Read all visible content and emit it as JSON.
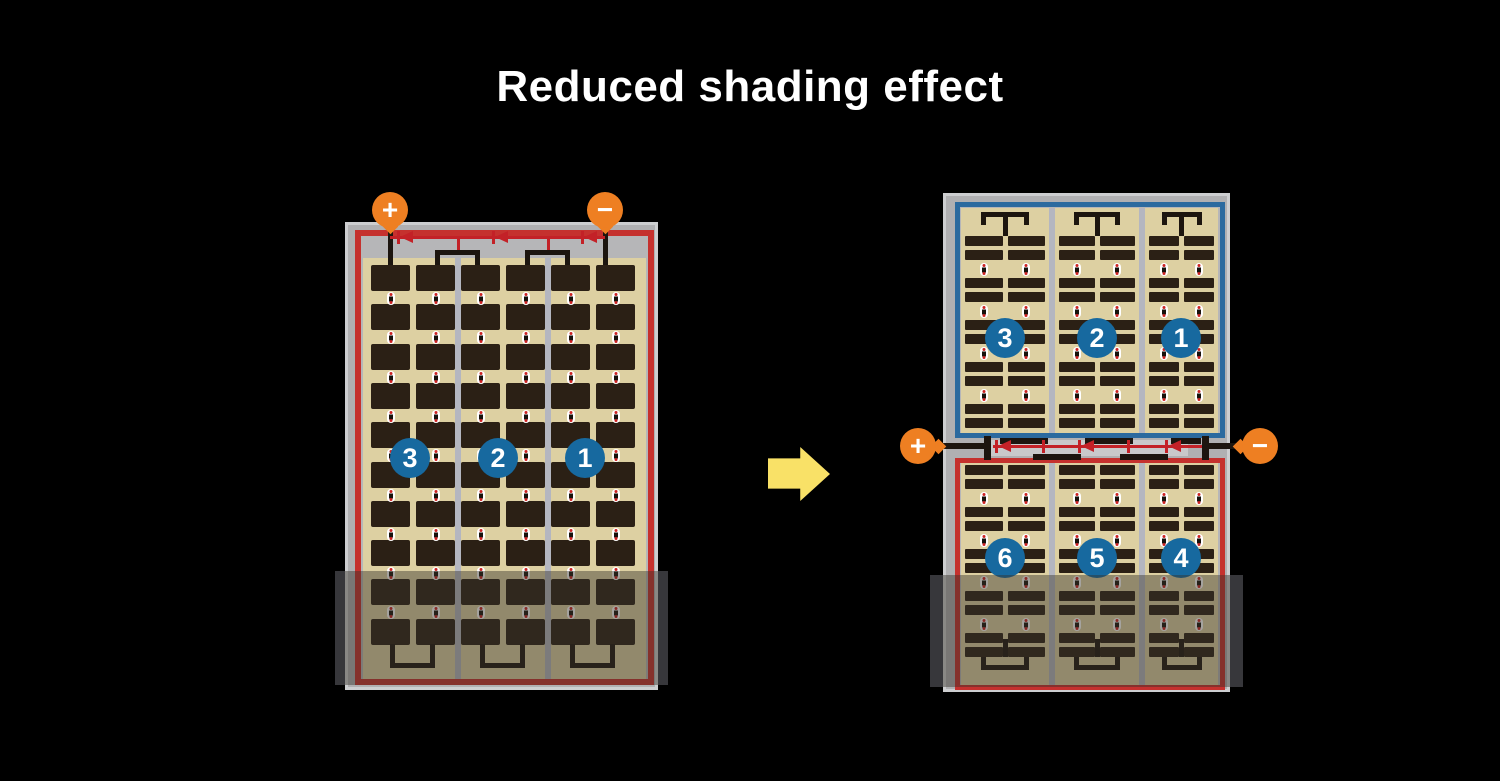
{
  "title": "Reduced shading effect",
  "colors": {
    "background": "#000000",
    "frame_gray": "#b0b0b2",
    "frame_edge": "#cdced0",
    "inner_gray": "#b6b6b8",
    "border_red": "#c5312e",
    "border_blue": "#2b6a9f",
    "cell_area_tan": "#ddd0a2",
    "cell_dark": "#2b2015",
    "divider_gray": "#b4b6c0",
    "busbar_black": "#1c150f",
    "junction_band_gray": "#c9c9cb",
    "diode_red": "#c32127",
    "terminal_orange": "#ee7f22",
    "string_circle_blue": "#17699f",
    "arrow_yellow": "#f9e167",
    "shade_band": "#37373b",
    "shade_overlay": "rgba(55,50,42,0.45)"
  },
  "left_panel": {
    "terminals": {
      "positive": "+",
      "negative": "−"
    },
    "strings": [
      "3",
      "2",
      "1"
    ],
    "cell_columns": 6,
    "cell_rows": 10,
    "bypass_diodes": 3,
    "shaded_region": "bottom"
  },
  "right_panel": {
    "terminals": {
      "positive": "+",
      "negative": "−"
    },
    "top_half": {
      "strings": [
        "3",
        "2",
        "1"
      ],
      "border": "blue"
    },
    "bottom_half": {
      "strings": [
        "6",
        "5",
        "4"
      ],
      "border": "red"
    },
    "cell_columns": 6,
    "bypass_diodes": 3,
    "shaded_region": "bottom"
  },
  "arrow": {
    "direction": "right"
  }
}
